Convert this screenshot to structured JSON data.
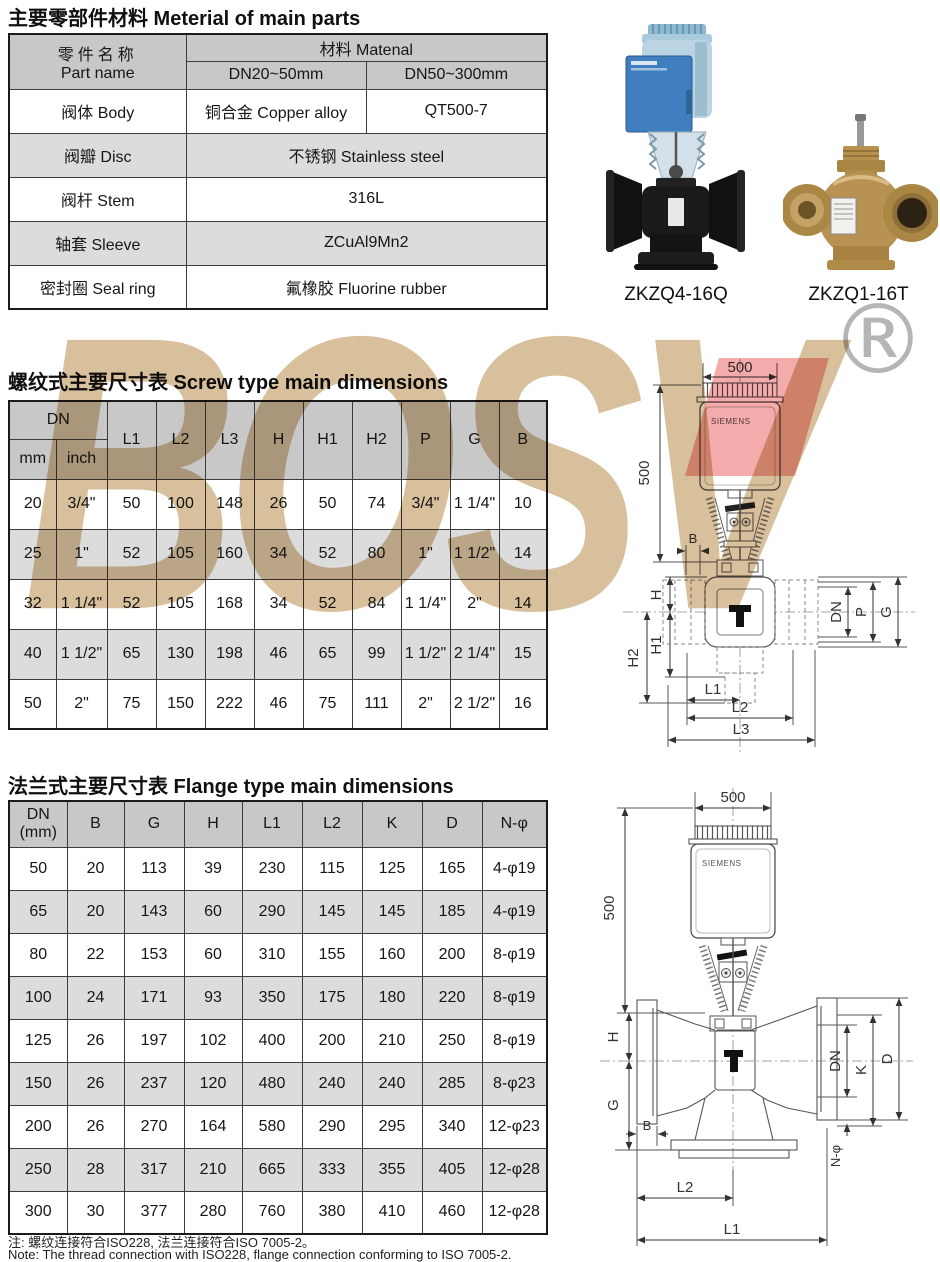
{
  "watermark": {
    "text": "BOSV",
    "registered": "®"
  },
  "materials": {
    "title": "主要零部件材料 Meterial of main parts",
    "header": {
      "part_name_zh": "零件名称",
      "part_name_en": "Part name",
      "material": "材料 Matenal",
      "range1": "DN20~50mm",
      "range2": "DN50~300mm"
    },
    "rows": [
      {
        "name": "阀体 Body",
        "v1": "铜合金 Copper alloy",
        "v2": "QT500-7"
      },
      {
        "name": "阀瓣 Disc",
        "v": "不锈钢 Stainless steel"
      },
      {
        "name": "阀杆 Stem",
        "v": "316L"
      },
      {
        "name": "轴套 Sleeve",
        "v": "ZCuAl9Mn2"
      },
      {
        "name": "密封圈 Seal ring",
        "v": "氟橡胶 Fluorine rubber"
      }
    ],
    "products": [
      {
        "model": "ZKZQ4-16Q"
      },
      {
        "model": "ZKZQ1-16T"
      }
    ]
  },
  "screw": {
    "title": "螺纹式主要尺寸表 Screw type main dimensions",
    "dn_label": "DN",
    "sub1": "mm",
    "sub2": "inch",
    "cols": [
      "L1",
      "L2",
      "L3",
      "H",
      "H1",
      "H2",
      "P",
      "G",
      "B"
    ],
    "rows": [
      [
        "20",
        "3/4\"",
        "50",
        "100",
        "148",
        "26",
        "50",
        "74",
        "3/4\"",
        "1 1/4\"",
        "10"
      ],
      [
        "25",
        "1\"",
        "52",
        "105",
        "160",
        "34",
        "52",
        "80",
        "1\"",
        "1 1/2\"",
        "14"
      ],
      [
        "32",
        "1 1/4\"",
        "52",
        "105",
        "168",
        "34",
        "52",
        "84",
        "1 1/4\"",
        "2\"",
        "14"
      ],
      [
        "40",
        "1 1/2\"",
        "65",
        "130",
        "198",
        "46",
        "65",
        "99",
        "1 1/2\"",
        "2 1/4\"",
        "15"
      ],
      [
        "50",
        "2\"",
        "75",
        "150",
        "222",
        "46",
        "75",
        "111",
        "2\"",
        "2 1/2\"",
        "16"
      ]
    ]
  },
  "flange": {
    "title": "法兰式主要尺寸表 Flange type main dimensions",
    "dn_line1": "DN",
    "dn_line2": "(mm)",
    "cols": [
      "B",
      "G",
      "H",
      "L1",
      "L2",
      "K",
      "D",
      "N-φ"
    ],
    "rows": [
      [
        "50",
        "20",
        "113",
        "39",
        "230",
        "115",
        "125",
        "165",
        "4-φ19"
      ],
      [
        "65",
        "20",
        "143",
        "60",
        "290",
        "145",
        "145",
        "185",
        "4-φ19"
      ],
      [
        "80",
        "22",
        "153",
        "60",
        "310",
        "155",
        "160",
        "200",
        "8-φ19"
      ],
      [
        "100",
        "24",
        "171",
        "93",
        "350",
        "175",
        "180",
        "220",
        "8-φ19"
      ],
      [
        "125",
        "26",
        "197",
        "102",
        "400",
        "200",
        "210",
        "250",
        "8-φ19"
      ],
      [
        "150",
        "26",
        "237",
        "120",
        "480",
        "240",
        "240",
        "285",
        "8-φ23"
      ],
      [
        "200",
        "26",
        "270",
        "164",
        "580",
        "290",
        "295",
        "340",
        "12-φ23"
      ],
      [
        "250",
        "28",
        "317",
        "210",
        "665",
        "333",
        "355",
        "405",
        "12-φ28"
      ],
      [
        "300",
        "30",
        "377",
        "280",
        "760",
        "380",
        "410",
        "460",
        "12-φ28"
      ]
    ]
  },
  "screw_drawing": {
    "dim_top": "500",
    "dim_side": "500",
    "brand": "SIEMENS",
    "b": "B",
    "h": "H",
    "h1": "H1",
    "h2": "H2",
    "dn": "DN",
    "p": "P",
    "g": "G",
    "l1": "L1",
    "l2": "L2",
    "l3": "L3"
  },
  "flange_drawing": {
    "dim_top": "500",
    "dim_side": "500",
    "brand": "SIEMENS",
    "h": "H",
    "g": "G",
    "b": "B",
    "dn": "DN",
    "k": "K",
    "d": "D",
    "n_phi": "N-φ",
    "l2": "L2",
    "l1": "L1"
  },
  "notes": {
    "zh": "注: 螺纹连接符合ISO228, 法兰连接符合ISO 7005-2。",
    "en": "Note: The thread connection with ISO228, flange connection conforming to ISO 7005-2."
  },
  "colors": {
    "header_bg": "#c8c8c8",
    "alt_row_bg": "#dcdcdc",
    "watermark_tan": "#d8c09d",
    "watermark_red": "#f3abab",
    "registered_grey": "#b5b5b5",
    "actuator_blue": "#3f7fc0",
    "valve_black": "#1a1a1a",
    "valve_brass": "#b68e50"
  }
}
